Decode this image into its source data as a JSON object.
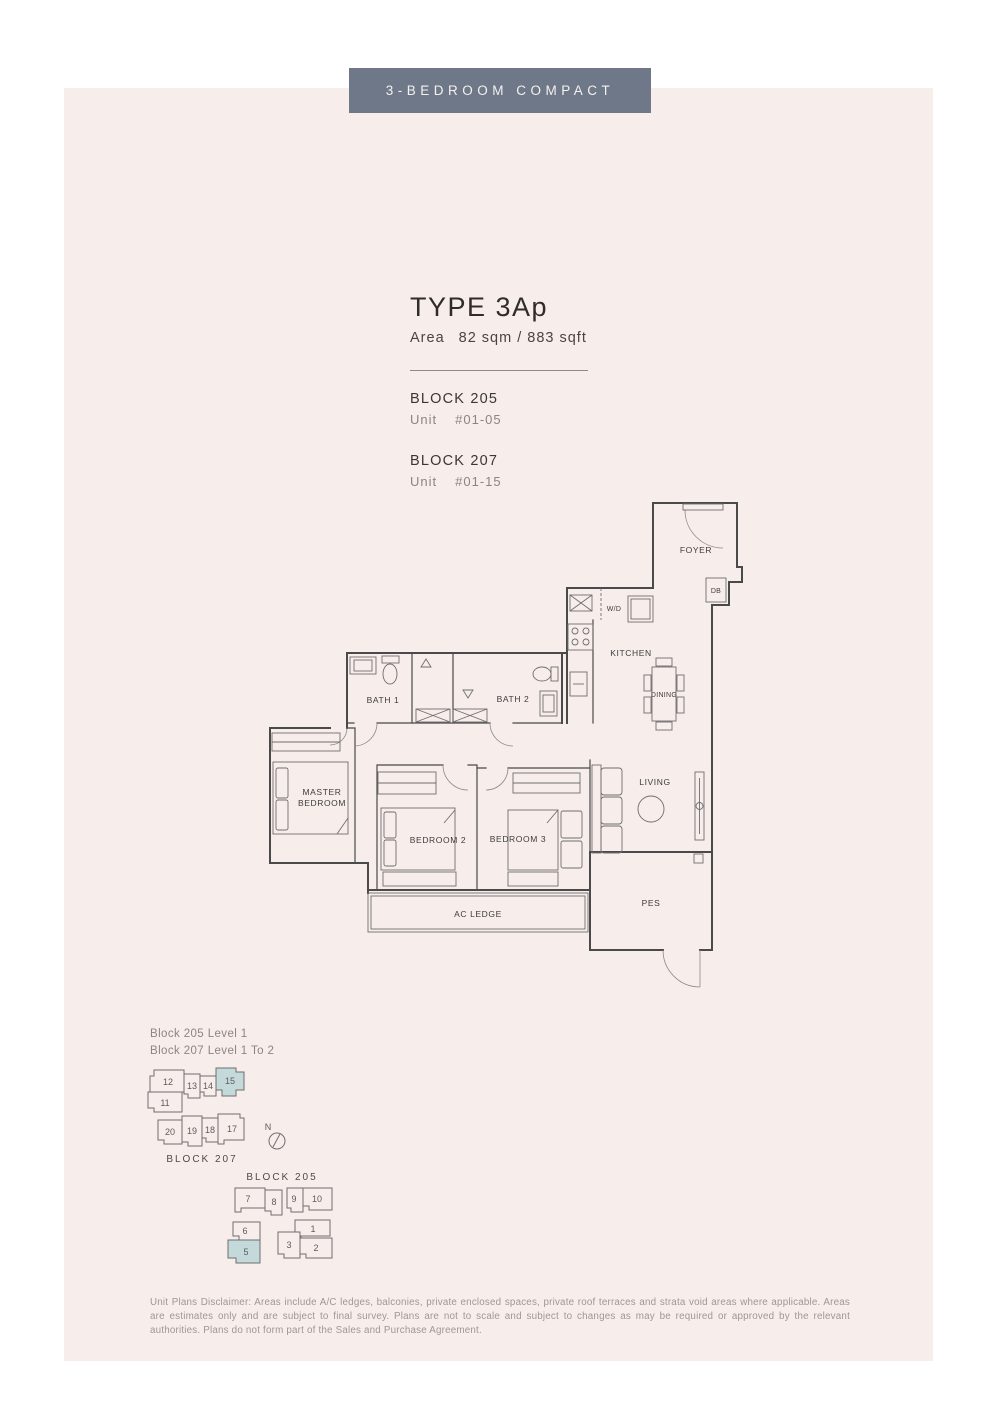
{
  "banner": {
    "label": "3-BEDROOM COMPACT"
  },
  "unit_info": {
    "type_title": "TYPE 3Ap",
    "area_label": "Area",
    "area_value": "82 sqm / 883 sqft",
    "blocks": [
      {
        "name": "BLOCK 205",
        "unit_label": "Unit",
        "unit_no": "#01-05"
      },
      {
        "name": "BLOCK 207",
        "unit_label": "Unit",
        "unit_no": "#01-15"
      }
    ]
  },
  "floorplan": {
    "labels": {
      "foyer": "FOYER",
      "db": "DB",
      "wd": "W/D",
      "kitchen": "KITCHEN",
      "dining": "DINING",
      "bath1": "BATH 1",
      "bath2": "BATH 2",
      "master_line1": "MASTER",
      "master_line2": "BEDROOM",
      "bedroom2": "BEDROOM 2",
      "bedroom3": "BEDROOM 3",
      "living": "LIVING",
      "pes": "PES",
      "ac_ledge": "AC LEDGE"
    }
  },
  "keyplans": {
    "levels": {
      "line1": "Block 205 Level 1",
      "line2": "Block 207 Level 1 To 2"
    },
    "compass_label": "N",
    "block207": {
      "label": "BLOCK 207",
      "highlighted_unit": "15",
      "units": {
        "u11": "11",
        "u12": "12",
        "u13": "13",
        "u14": "14",
        "u15": "15",
        "u17": "17",
        "u18": "18",
        "u19": "19",
        "u20": "20"
      }
    },
    "block205": {
      "label": "BLOCK 205",
      "highlighted_unit": "5",
      "units": {
        "u1": "1",
        "u2": "2",
        "u3": "3",
        "u5": "5",
        "u6": "6",
        "u7": "7",
        "u8": "8",
        "u9": "9",
        "u10": "10"
      }
    }
  },
  "colors": {
    "banner_bg": "#6e7888",
    "panel_bg": "#f7edeb",
    "highlight": "#c3d9da"
  },
  "disclaimer": "Unit Plans Disclaimer: Areas include A/C ledges, balconies, private enclosed spaces, private roof terraces and strata void areas where applicable. Areas are estimates only and are subject to final survey. Plans are not to scale and subject to changes as may be required or approved by the relevant authorities. Plans do not form part of the Sales and Purchase Agreement."
}
